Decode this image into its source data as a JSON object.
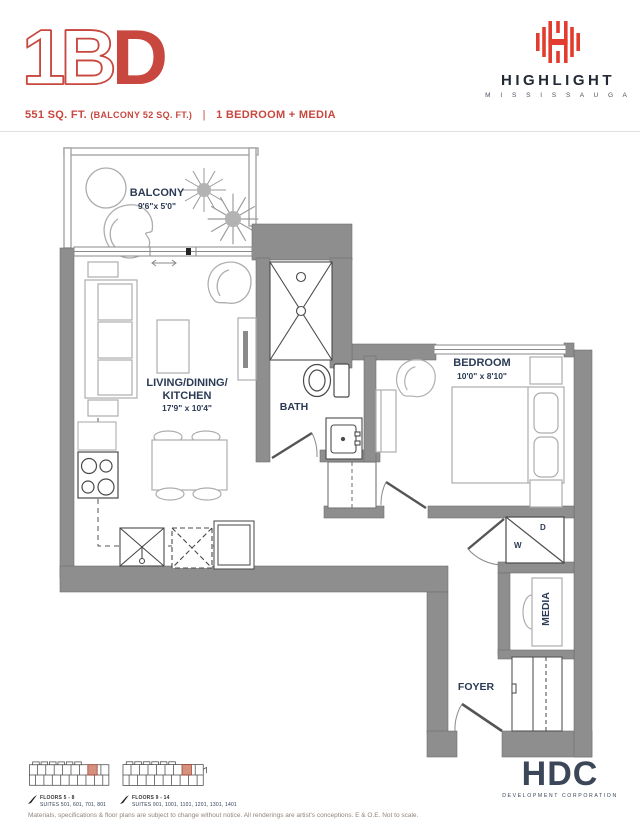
{
  "header": {
    "code_outline": "1B",
    "code_solid": "D",
    "area": "551 SQ. FT.",
    "balcony_area": "(BALCONY 52 SQ. FT.)",
    "divider": "|",
    "type": "1 BEDROOM + MEDIA"
  },
  "brand": {
    "name": "HIGHLIGHT",
    "city": "M I S S I S S A U G A"
  },
  "rooms": {
    "balcony": {
      "name": "BALCONY",
      "dims": "9'6\"x 5'0\""
    },
    "living": {
      "line1": "LIVING/DINING/",
      "line2": "KITCHEN",
      "dims": "17'9\" x 10'4\""
    },
    "bath": {
      "name": "BATH"
    },
    "bedroom": {
      "name": "BEDROOM",
      "dims": "10'0\" x 8'10\""
    },
    "media": {
      "name": "MEDIA"
    },
    "foyer": {
      "name": "FOYER"
    },
    "laundry": {
      "washer": "W",
      "dryer": "D"
    }
  },
  "keyplans": [
    {
      "floors": "FLOORS 5 - 8",
      "suites": "SUITES 501, 601, 701, 801"
    },
    {
      "floors": "FLOORS 9 - 14",
      "suites": "SUITES 901, 1001, 1101, 1201, 1301, 1401"
    }
  ],
  "footer": {
    "disclaimer": "Materials, specifications & floor plans are subject to change without notice. All renderings are artist's conceptions. E & O.E. Not to scale.",
    "developer": {
      "name": "HDC",
      "tagline": "DEVELOPMENT CORPORATION"
    }
  },
  "colors": {
    "accent_red": "#C8473F",
    "logo_red": "#E23B2F",
    "wall_gray": "#8C8C8C",
    "label_navy": "#2B3A55",
    "keyplan_highlight": "#D6917D",
    "developer_navy": "#3B4759"
  }
}
